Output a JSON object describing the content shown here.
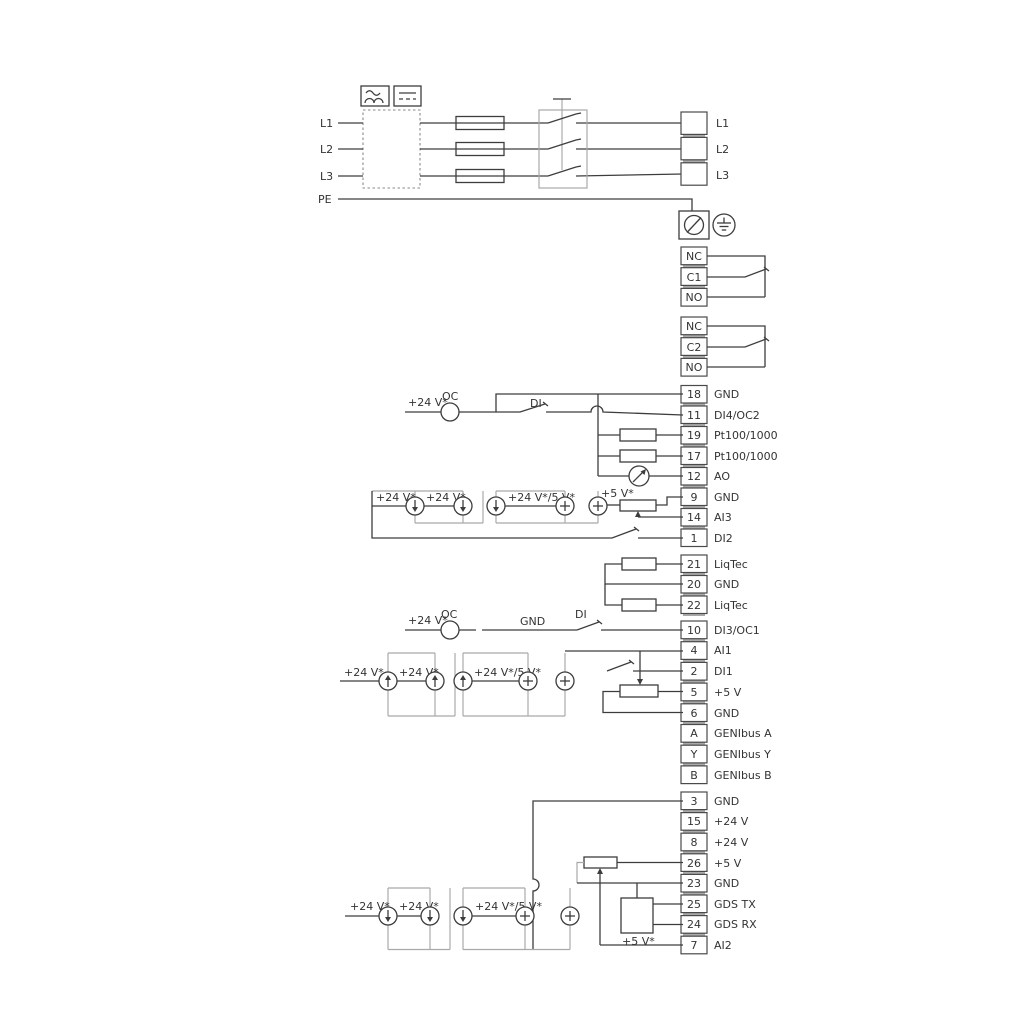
{
  "power_in": {
    "l1": "L1",
    "l2": "L2",
    "l3": "L3",
    "pe": "PE"
  },
  "power_out": [
    "L1",
    "L2",
    "L3"
  ],
  "relay1": [
    "NC",
    "C1",
    "NO"
  ],
  "relay2": [
    "NC",
    "C2",
    "NO"
  ],
  "wire_labels": {
    "v24": "+24 V*",
    "v24_5": "+24 V*/5 V*",
    "v5": "+5 V*",
    "oc": "OC",
    "di": "DI",
    "gnd": "GND"
  },
  "io_a": [
    {
      "num": "18",
      "label": "GND"
    },
    {
      "num": "11",
      "label": "DI4/OC2"
    },
    {
      "num": "19",
      "label": "Pt100/1000"
    },
    {
      "num": "17",
      "label": "Pt100/1000"
    },
    {
      "num": "12",
      "label": "AO"
    },
    {
      "num": "9",
      "label": "GND"
    },
    {
      "num": "14",
      "label": "AI3"
    },
    {
      "num": "1",
      "label": "DI2"
    }
  ],
  "io_b": [
    {
      "num": "21",
      "label": "LiqTec"
    },
    {
      "num": "20",
      "label": "GND"
    },
    {
      "num": "22",
      "label": "LiqTec"
    }
  ],
  "io_c": [
    {
      "num": "10",
      "label": "DI3/OC1"
    },
    {
      "num": "4",
      "label": "AI1"
    },
    {
      "num": "2",
      "label": "DI1"
    },
    {
      "num": "5",
      "label": "+5 V"
    },
    {
      "num": "6",
      "label": "GND"
    },
    {
      "num": "A",
      "label": "GENIbus A"
    },
    {
      "num": "Y",
      "label": "GENIbus Y"
    },
    {
      "num": "B",
      "label": "GENIbus B"
    }
  ],
  "io_d": [
    {
      "num": "3",
      "label": "GND"
    },
    {
      "num": "15",
      "label": "+24 V"
    },
    {
      "num": "8",
      "label": "+24 V"
    },
    {
      "num": "26",
      "label": "+5 V"
    },
    {
      "num": "23",
      "label": "GND"
    },
    {
      "num": "25",
      "label": "GDS TX"
    },
    {
      "num": "24",
      "label": "GDS RX"
    },
    {
      "num": "7",
      "label": "AI2"
    }
  ]
}
